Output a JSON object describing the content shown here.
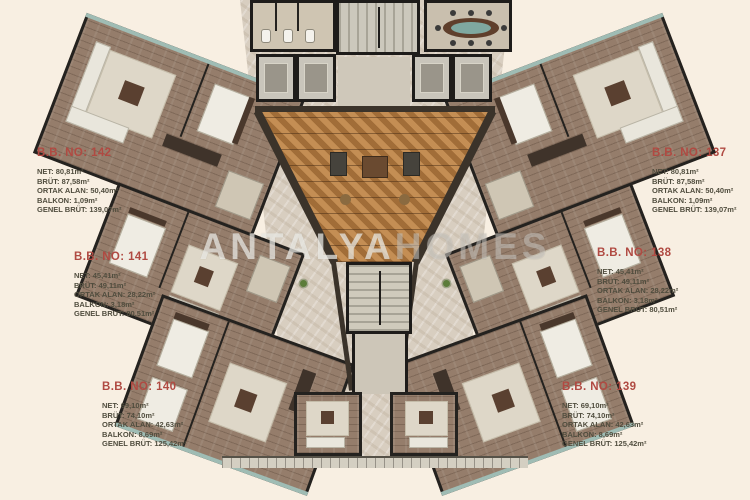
{
  "watermark": {
    "primary": "ANTALYA",
    "secondary": "HOMES"
  },
  "units": [
    {
      "no": "B.B. NO: 142",
      "lines": [
        "NET: 80,81m²",
        "BRÜT: 87,58m²",
        "ORTAK ALAN: 50,40m²",
        "BALKON: 1,09m²",
        "GENEL BRÜT: 139,07m²"
      ]
    },
    {
      "no": "B.B. NO: 141",
      "lines": [
        "NET: 45,41m²",
        "BRÜT: 49,11m²",
        "ORTAK ALAN: 28,22m²",
        "BALKON: 3,18m²",
        "GENEL BRÜT: 80,51m²"
      ]
    },
    {
      "no": "B.B. NO: 140",
      "lines": [
        "NET: 69,10m²",
        "BRÜT: 74,10m²",
        "ORTAK ALAN: 42,63m²",
        "BALKON: 8,69m²",
        "GENEL BRÜT: 125,42m²"
      ]
    },
    {
      "no": "B.B. NO: 137",
      "lines": [
        "NET: 80,81m²",
        "BRÜT: 87,58m²",
        "ORTAK ALAN: 50,40m²",
        "BALKON: 1,09m²",
        "GENEL BRÜT: 139,07m²"
      ]
    },
    {
      "no": "B.B. NO: 138",
      "lines": [
        "NET: 45,41m²",
        "BRÜT: 49,11m²",
        "ORTAK ALAN: 28,22m²",
        "BALKON: 3,18m²",
        "GENEL BRÜT: 80,51m²"
      ]
    },
    {
      "no": "B.B. NO: 139",
      "lines": [
        "NET: 69,10m²",
        "BRÜT: 74,10m²",
        "ORTAK ALAN: 42,63m²",
        "BALKON: 8,69m²",
        "GENEL BRÜT: 125,42m²"
      ]
    }
  ],
  "colors": {
    "background": "#f8efe2",
    "label_red": "#b04a42",
    "label_text": "#504d3e",
    "wall": "#24221f",
    "wood": "#957d6b",
    "marble": "#d8cec0",
    "herringbone": "#b5804a",
    "glass": "#9fbcb4"
  }
}
